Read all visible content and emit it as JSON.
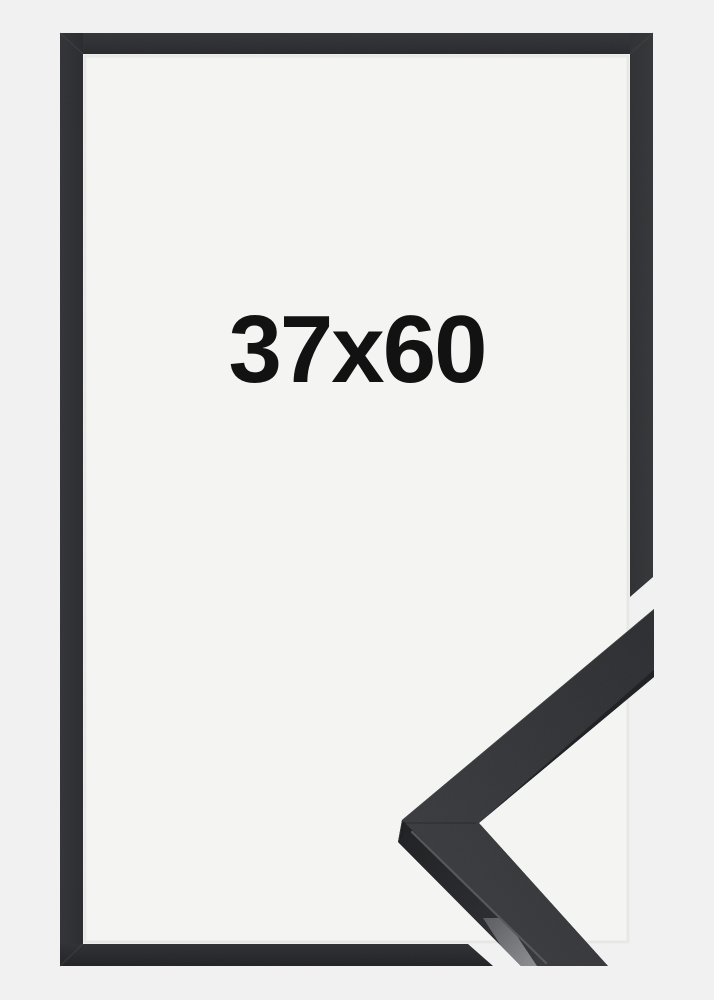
{
  "product": {
    "size_label": "37x60"
  },
  "colors": {
    "page_background": "#f0f1f0",
    "inner_background": "#f4f4f3",
    "frame_moulding": "#323336",
    "frame_moulding_dark": "#26272a",
    "sample_top_face": "#333437",
    "sample_side_face": "#222326",
    "sample_end_face": "#7e7f83",
    "sample_edge_highlight": "#55565a",
    "label_text": "#121212"
  }
}
